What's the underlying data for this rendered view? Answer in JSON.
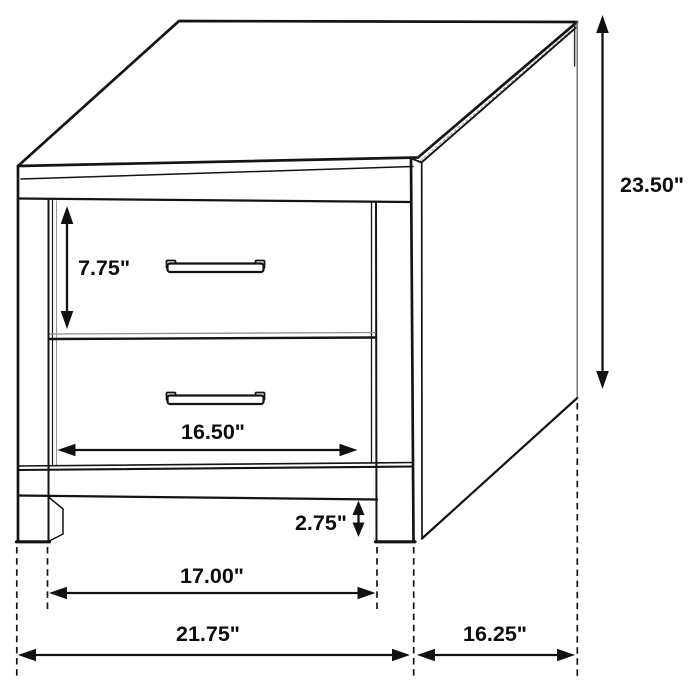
{
  "diagram": {
    "subject": "two-drawer nightstand dimensional line drawing",
    "unit": "inches",
    "colors": {
      "line": "#141414",
      "background": "#ffffff",
      "soft_edge": "#8f8f8f"
    },
    "labels": {
      "drawer_height": "7.75\"",
      "overall_height": "23.50\"",
      "drawer_width": "16.50\"",
      "base_clearance": "2.75\"",
      "leg_span_inner": "17.00\"",
      "overall_width": "21.75\"",
      "overall_depth": "16.25\""
    }
  }
}
